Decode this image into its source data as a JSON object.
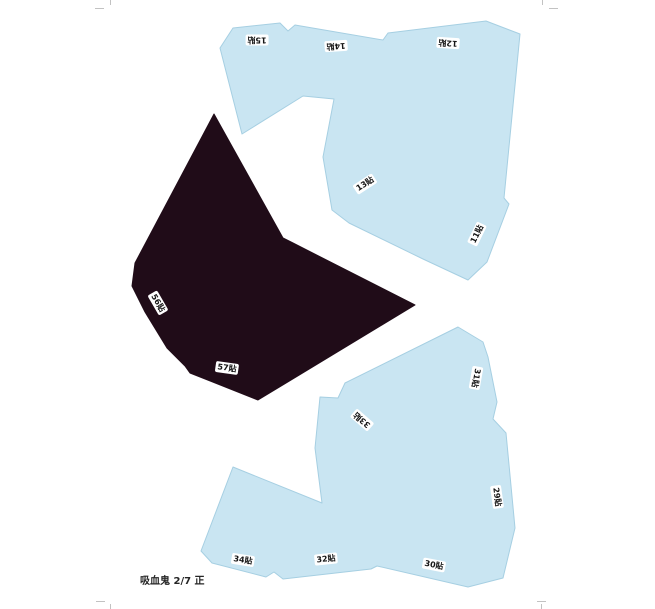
{
  "footer": {
    "text": "吸血鬼 2/7 正"
  },
  "colors": {
    "background": "#ffffff",
    "piece_blue": "#c9e5f2",
    "piece_blue_edge": "#a6cfe2",
    "piece_dark": "#200c18",
    "label_bg": "#ffffff",
    "label_text": "#161616",
    "crop_mark": "#c2c2c2",
    "footer_text": "#262626"
  },
  "pieces": {
    "top": {
      "fill": "#c9e5f2",
      "points": "220,48 233,28 280,23 288,31 295,25 383,40 388,33 486,21 520,34 504,198 509,204 487,262 468,280 423,259 349,223 332,210 323,157 334,99 303,96 242,134"
    },
    "dark": {
      "fill": "#200c18",
      "points": "214,114 283,238 293,243 415,305 258,400 190,373 185,366 167,348 145,312 132,286 135,263"
    },
    "bottom": {
      "fill": "#c9e5f2",
      "points": "458,327 483,342 488,357 497,402 493,419 506,433 515,528 503,578 468,587 377,566 371,569 283,579 274,572 266,577 212,563 201,551 233,467 322,503 315,448 320,397 338,398 345,383"
    }
  },
  "tab_labels": [
    {
      "text": "15貼",
      "x": 257,
      "y": 40,
      "rot": 180
    },
    {
      "text": "14貼",
      "x": 336,
      "y": 46,
      "rot": 176
    },
    {
      "text": "12貼",
      "x": 448,
      "y": 43,
      "rot": 184
    },
    {
      "text": "13貼",
      "x": 365,
      "y": 184,
      "rot": -33
    },
    {
      "text": "11貼",
      "x": 477,
      "y": 234,
      "rot": -64
    },
    {
      "text": "56貼",
      "x": 158,
      "y": 303,
      "rot": 60
    },
    {
      "text": "57貼",
      "x": 227,
      "y": 368,
      "rot": 8
    },
    {
      "text": "31貼",
      "x": 476,
      "y": 378,
      "rot": 100
    },
    {
      "text": "33貼",
      "x": 362,
      "y": 420,
      "rot": 221
    },
    {
      "text": "29貼",
      "x": 497,
      "y": 497,
      "rot": 82
    },
    {
      "text": "34貼",
      "x": 243,
      "y": 560,
      "rot": 9
    },
    {
      "text": "32貼",
      "x": 326,
      "y": 559,
      "rot": -6
    },
    {
      "text": "30貼",
      "x": 434,
      "y": 565,
      "rot": 11
    }
  ]
}
